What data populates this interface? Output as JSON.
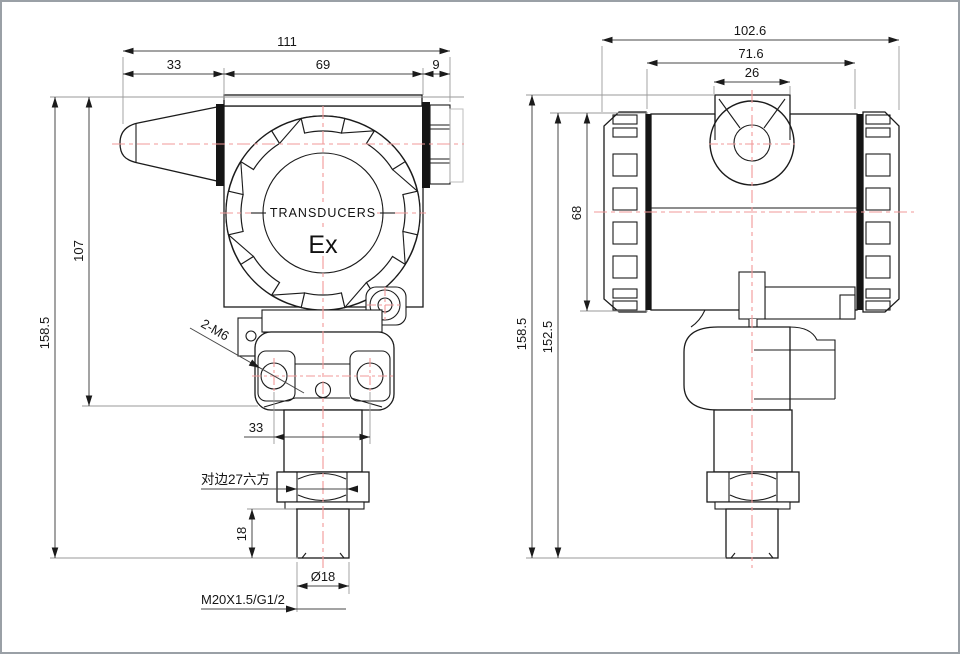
{
  "page": {
    "background": "#ffffff",
    "border_color": "#9aa0a6"
  },
  "drawing_type": "pressure transmitter dimensional drawing, front and side views",
  "colors": {
    "outline": "#1b1b1b",
    "dimension": "#474747",
    "centerline": "#f19898"
  },
  "front_view": {
    "cover_text": "TRANSDUCERS",
    "ex_mark": "Ex",
    "dim_overall_width": "111",
    "dim_gland_width": "33",
    "dim_body_width": "69",
    "dim_connector_width": "9",
    "dim_overall_height": "158.5",
    "dim_body_height": "107",
    "dim_hole_spacing": "33",
    "note_mounting_holes": "2-M6",
    "note_hex": "对边27六方",
    "dim_thread_length": "18",
    "dim_tip_diameter": "Ø18",
    "note_thread": "M20X1.5/G1/2"
  },
  "side_view": {
    "dim_overall_width": "102.6",
    "dim_body_width": "71.6",
    "dim_conduit_boss_width": "26",
    "dim_overall_height": "158.5",
    "dim_height_below_boss": "152.5",
    "dim_cap_height": "68"
  }
}
